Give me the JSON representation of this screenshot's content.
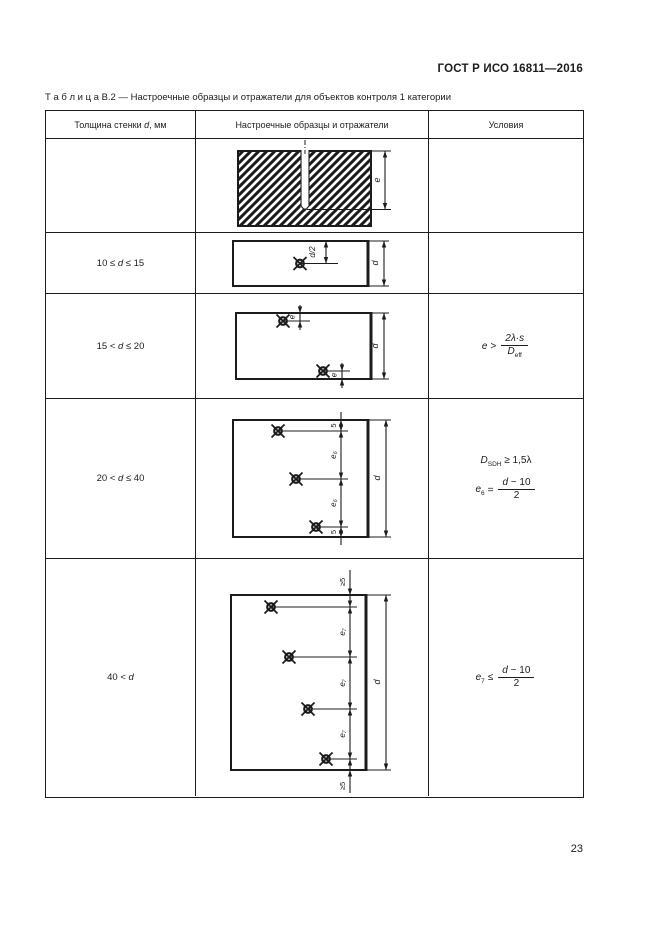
{
  "header": {
    "title": "ГОСТ Р ИСО 16811—2016"
  },
  "caption": "Т а б л и ц а  В.2 — Настроечные образцы и отражатели для объектов контроля 1 категории",
  "table": {
    "col_headers": {
      "thickness": {
        "pre": "Толщина стенки ",
        "var": "d",
        "post": ", мм"
      },
      "samples": "Настроечные образцы и отражатели",
      "conditions": "Условия"
    },
    "rows": {
      "r2": {
        "thickness": {
          "pre": "10 ≤ ",
          "var": "d",
          "post": " ≤ 15"
        }
      },
      "r3": {
        "thickness": {
          "pre": "15 < ",
          "var": "d",
          "post": " ≤ 20"
        },
        "condition": {
          "var": "e",
          "rel": ">",
          "num": "2λ·s",
          "den_base": "D",
          "den_sub": "eff"
        }
      },
      "r4": {
        "thickness": {
          "pre": "20 < ",
          "var": "d",
          "post": " ≤ 40"
        },
        "condition1": {
          "base": "D",
          "sub": "SDH",
          "rest": " ≥ 1,5λ"
        },
        "condition2": {
          "base": "e",
          "sub": "6",
          "eq": "=",
          "num_var": "d",
          "num_rest": " − 10",
          "den": "2"
        }
      },
      "r5": {
        "thickness": {
          "pre": "40 < ",
          "var": "d",
          "post": ""
        },
        "condition": {
          "base": "e",
          "sub": "7",
          "eq": "≤",
          "num_var": "d",
          "num_rest": " − 10",
          "den": "2"
        }
      }
    }
  },
  "diagrams": {
    "row1": {
      "depth": "e"
    },
    "row2": {
      "half": "d/2",
      "height": "d"
    },
    "row3": {
      "offset_top": "e",
      "offset_bottom": "e",
      "height": "d"
    },
    "row4": {
      "edge_top": "5",
      "spacing1": "e₆",
      "spacing2": "e₆",
      "edge_bottom": "5",
      "height": "d"
    },
    "row5": {
      "edge_top": "≥5",
      "spacing1": "e₇",
      "spacing2": "e₇",
      "spacing3": "e₇",
      "edge_bottom": "≥5",
      "height": "d"
    }
  },
  "footer": {
    "page_number": "23"
  }
}
